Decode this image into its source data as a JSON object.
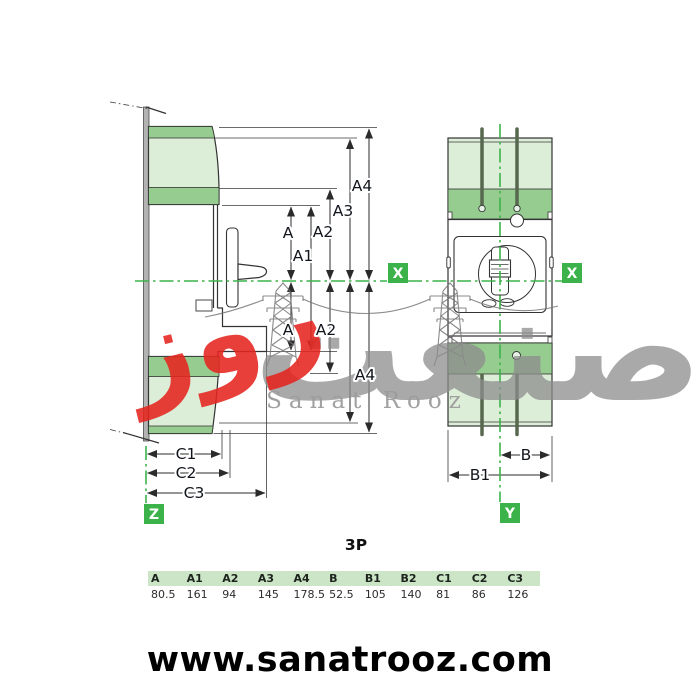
{
  "pole_label": "3P",
  "axes": {
    "x": "X",
    "y": "Y",
    "z": "Z"
  },
  "dims": {
    "a": "A",
    "a1": "A1",
    "a2": "A2",
    "a3": "A3",
    "a4": "A4",
    "b": "B",
    "b1": "B1",
    "c1": "C1",
    "c2": "C2",
    "c3": "C3"
  },
  "watermark": {
    "fa_main": "صنعت",
    "fa_sub": "روز",
    "latin": "Sanat Rooz"
  },
  "table": {
    "headers": [
      "A",
      "A1",
      "A2",
      "A3",
      "A4",
      "B",
      "B1",
      "B2",
      "C1",
      "C2",
      "C3"
    ],
    "values": [
      "80.5",
      "161",
      "94",
      "145",
      "178.5",
      "52.5",
      "105",
      "140",
      "81",
      "86",
      "126"
    ]
  },
  "footer_url": "www.sanatrooz.com",
  "colors": {
    "axis_green": "#3cb34a",
    "shield_light": "#dcedd8",
    "shield_dark": "#97cc90",
    "table_header_bg": "#cbe5c6",
    "watermark_red": "#e6251f",
    "watermark_gray": "#8d8d8d",
    "watermark_latin_gray": "#9c9c9c"
  }
}
